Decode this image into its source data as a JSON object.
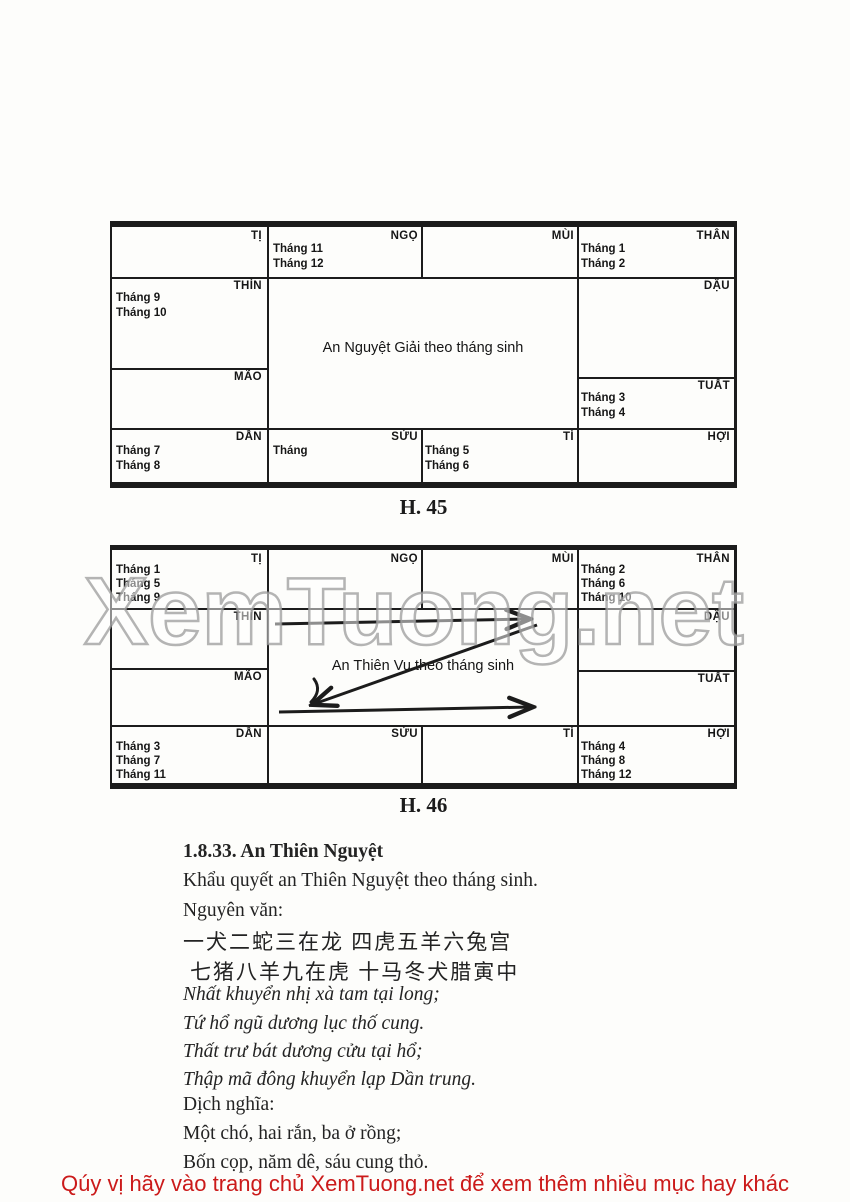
{
  "ink_color": "#1c1c1c",
  "watermark": {
    "text": "XemTuong.net",
    "outline_color": "#9b9b9b"
  },
  "fig45": {
    "caption": "H. 45",
    "center_label": "An Nguyệt Giải theo tháng sinh",
    "cells": {
      "ti": {
        "label": "TỊ",
        "months": []
      },
      "ngo": {
        "label": "NGỌ",
        "months": [
          "Tháng 11",
          "Tháng 12"
        ]
      },
      "mui": {
        "label": "MÙI",
        "months": []
      },
      "than": {
        "label": "THÂN",
        "months": [
          "Tháng 1",
          "Tháng 2"
        ]
      },
      "thin": {
        "label": "THÌN",
        "months": [
          "Tháng 9",
          "Tháng 10"
        ]
      },
      "dau": {
        "label": "DẬU",
        "months": []
      },
      "mao": {
        "label": "MÃO",
        "months": []
      },
      "tuat": {
        "label": "TUẤT",
        "months": [
          "Tháng 3",
          "Tháng 4"
        ]
      },
      "dan": {
        "label": "DẦN",
        "months": [
          "Tháng 7",
          "Tháng 8"
        ]
      },
      "suu": {
        "label": "SỬU",
        "months": [
          "Tháng"
        ]
      },
      "ty": {
        "label": "TÍ",
        "months": [
          "Tháng 5",
          "Tháng 6"
        ]
      },
      "hoi": {
        "label": "HỢI",
        "months": []
      }
    }
  },
  "fig46": {
    "caption": "H. 46",
    "center_label": "An Thiên Vu theo tháng sinh",
    "cells": {
      "ti": {
        "label": "TỊ",
        "months": [
          "Tháng 1",
          "Tháng 5",
          "Tháng 9"
        ]
      },
      "ngo": {
        "label": "NGỌ",
        "months": []
      },
      "mui": {
        "label": "MÙI",
        "months": []
      },
      "than": {
        "label": "THÂN",
        "months": [
          "Tháng 2",
          "Tháng 6",
          "Tháng 10"
        ]
      },
      "thin": {
        "label": "THÌN",
        "months": []
      },
      "dau": {
        "label": "DẬU",
        "months": []
      },
      "mao": {
        "label": "MÃO",
        "months": []
      },
      "tuat": {
        "label": "TUẤT",
        "months": []
      },
      "dan": {
        "label": "DẦN",
        "months": [
          "Tháng 3",
          "Tháng 7",
          "Tháng 11"
        ]
      },
      "suu": {
        "label": "SỬU",
        "months": []
      },
      "ty": {
        "label": "TÍ",
        "months": []
      },
      "hoi": {
        "label": "HỢI",
        "months": [
          "Tháng 4",
          "Tháng 8",
          "Tháng 12"
        ]
      }
    }
  },
  "section": {
    "heading": "1.8.33. An Thiên Nguyệt",
    "intro": "Khẩu quyết an Thiên Nguyệt theo tháng sinh.",
    "nguyen_van_label": "Nguyên văn:",
    "chinese": [
      "一犬二蛇三在龙 四虎五羊六兔宫",
      "七猪八羊九在虎 十马冬犬腊寅中"
    ],
    "han_viet": [
      "Nhất khuyển nhị xà tam tại long;",
      "Tứ hổ ngũ dương lục thố cung.",
      "Thất trư bát dương cửu tại hổ;",
      "Thập mã đông khuyển lạp Dần trung."
    ],
    "dich_nghia_label": "Dịch nghĩa:",
    "dich_nghia": [
      "Một chó, hai rắn, ba ở rồng;",
      "Bốn cọp, năm dê, sáu cung thỏ."
    ]
  },
  "footer": {
    "text": "Qúy vị hãy vào trang chủ XemTuong.net để xem thêm nhiều mục hay khác",
    "color": "#cb1a1a"
  }
}
